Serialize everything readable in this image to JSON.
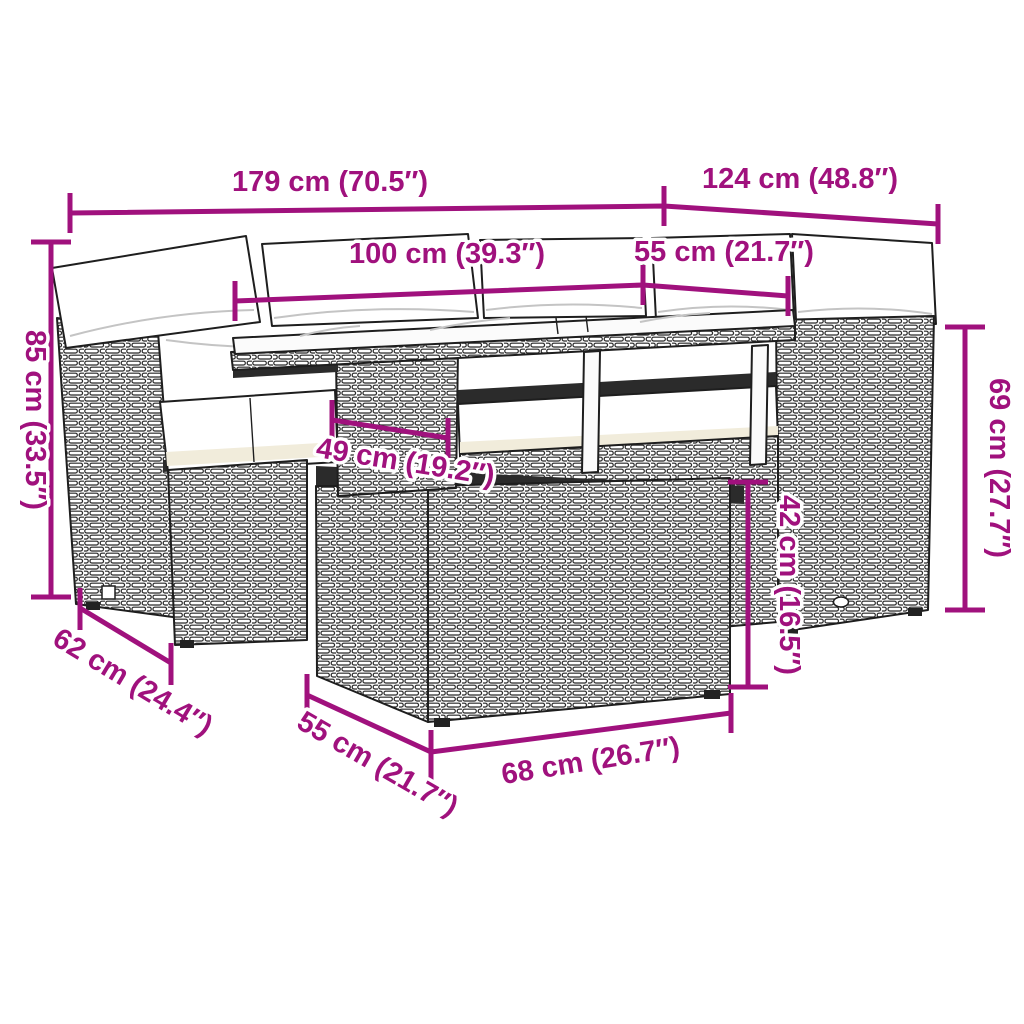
{
  "colors": {
    "dimension_accent": "#A0117D",
    "line_art": "#1E1E1E",
    "cushion_shade": "#F1ECDB",
    "background": "#FFFFFF"
  },
  "labels": {
    "total_width": "179 cm (70.5″)",
    "total_depth": "124 cm (48.8″)",
    "table_width": "100 cm (39.3″)",
    "right_seat_depth": "55 cm (21.7″)",
    "sofa_height": "85 cm (33.5″)",
    "right_section_height": "69 cm (27.7″)",
    "table_shelf_width": "49 cm (19.2″)",
    "stool_height": "42 cm (16.5″)",
    "left_section_depth": "62 cm (24.4″)",
    "stool_depth": "55 cm (21.7″)",
    "stool_width": "68 cm (26.7″)"
  }
}
